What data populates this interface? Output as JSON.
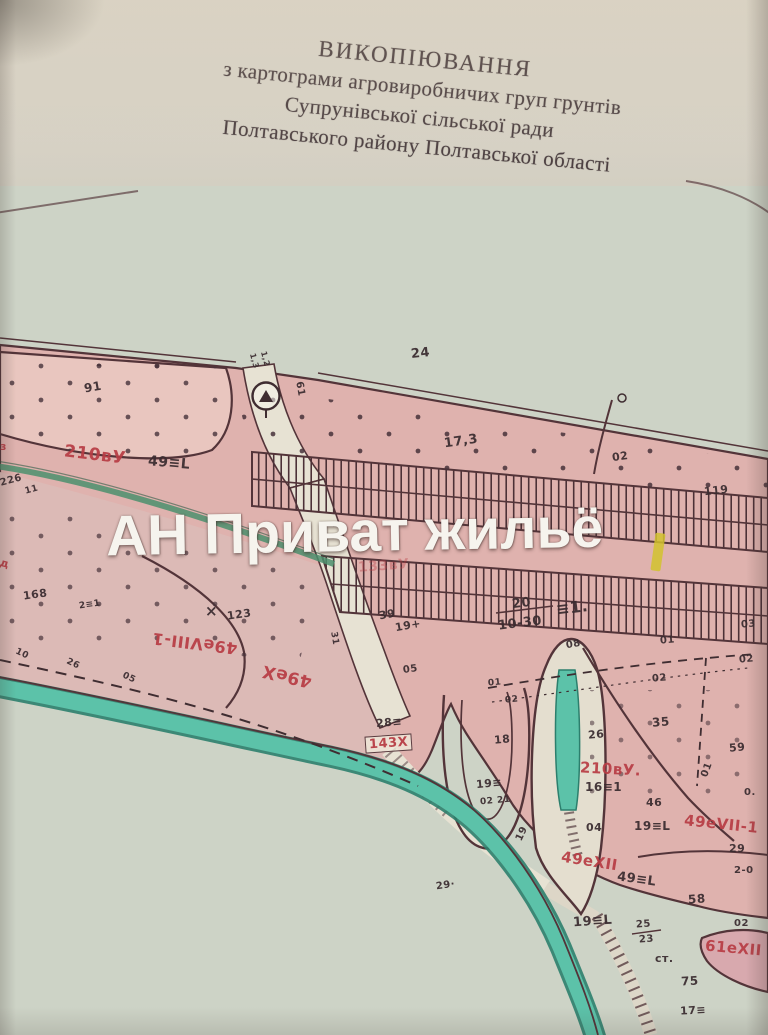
{
  "page": {
    "title_lines": [
      "ВИКОПІЮВАННЯ",
      "з картограми  агровиробничих груп грунтів",
      "Супрунівської сільської ради",
      "Полтавського району Полтавської області"
    ]
  },
  "watermark": {
    "text": "АН Приват жильё"
  },
  "map": {
    "labels": [
      {
        "t": "24",
        "x": 411,
        "y": 347,
        "s": 13,
        "r": -6
      },
      {
        "t": "91",
        "x": 84,
        "y": 381,
        "s": 12,
        "r": -10
      },
      {
        "t": "1,3",
        "x": 246,
        "y": 357,
        "s": 8,
        "r": 75
      },
      {
        "t": "1,2",
        "x": 257,
        "y": 355,
        "s": 8,
        "r": 75
      },
      {
        "t": "61",
        "x": 292,
        "y": 384,
        "s": 10,
        "r": 80
      },
      {
        "t": "17,3",
        "x": 444,
        "y": 435,
        "s": 13,
        "r": -8
      },
      {
        "t": "02",
        "x": 612,
        "y": 451,
        "s": 11,
        "r": -8
      },
      {
        "t": "119",
        "x": 704,
        "y": 485,
        "s": 11,
        "r": -6
      },
      {
        "t": "210вУ",
        "x": 64,
        "y": 447,
        "s": 17,
        "r": 7,
        "c": "r"
      },
      {
        "t": "49≡L",
        "x": 148,
        "y": 456,
        "s": 14,
        "r": 5
      },
      {
        "t": "226",
        "x": 0,
        "y": 476,
        "s": 10,
        "r": -15
      },
      {
        "t": "11",
        "x": 25,
        "y": 486,
        "s": 9,
        "r": -15
      },
      {
        "t": "з",
        "x": 0,
        "y": 441,
        "s": 11,
        "r": 0,
        "c": "r"
      },
      {
        "t": "133вУ",
        "x": 358,
        "y": 559,
        "s": 14,
        "r": -4,
        "c": "fr"
      },
      {
        "t": "20",
        "x": 512,
        "y": 597,
        "s": 13,
        "r": -7
      },
      {
        "t": "10-30",
        "x": 498,
        "y": 617,
        "s": 13,
        "r": -7
      },
      {
        "t": "≡1.",
        "x": 556,
        "y": 600,
        "s": 16,
        "r": -7
      },
      {
        "t": "39",
        "x": 379,
        "y": 609,
        "s": 11,
        "r": -10
      },
      {
        "t": "19+",
        "x": 395,
        "y": 620,
        "s": 11,
        "r": -10
      },
      {
        "t": "168",
        "x": 23,
        "y": 589,
        "s": 11,
        "r": -8
      },
      {
        "t": "2≡1",
        "x": 79,
        "y": 601,
        "s": 9,
        "r": -8
      },
      {
        "t": "×",
        "x": 205,
        "y": 604,
        "s": 15,
        "r": 0
      },
      {
        "t": "123",
        "x": 227,
        "y": 609,
        "s": 11,
        "r": -8
      },
      {
        "t": "49еVIII-1",
        "x": 152,
        "y": 635,
        "s": 16,
        "r": 187,
        "c": "r"
      },
      {
        "t": "д",
        "x": 0,
        "y": 558,
        "s": 11,
        "r": 15,
        "c": "r"
      },
      {
        "t": "49еХ",
        "x": 262,
        "y": 667,
        "s": 17,
        "r": 193,
        "c": "r"
      },
      {
        "t": "05",
        "x": 403,
        "y": 665,
        "s": 10,
        "r": -8
      },
      {
        "t": "31",
        "x": 327,
        "y": 634,
        "s": 9,
        "r": 80
      },
      {
        "t": "10",
        "x": 15,
        "y": 650,
        "s": 9,
        "r": 25
      },
      {
        "t": "26",
        "x": 66,
        "y": 660,
        "s": 9,
        "r": 25
      },
      {
        "t": "05",
        "x": 122,
        "y": 674,
        "s": 9,
        "r": 25
      },
      {
        "t": "28≡",
        "x": 376,
        "y": 717,
        "s": 11,
        "r": -5
      },
      {
        "t": "143Х",
        "x": 365,
        "y": 735,
        "s": 13,
        "r": -4,
        "c": "r",
        "box": true
      },
      {
        "t": "18",
        "x": 494,
        "y": 734,
        "s": 11,
        "r": -5
      },
      {
        "t": "26",
        "x": 588,
        "y": 729,
        "s": 11,
        "r": -5
      },
      {
        "t": "35",
        "x": 652,
        "y": 716,
        "s": 12,
        "r": -5
      },
      {
        "t": "08",
        "x": 566,
        "y": 640,
        "s": 10,
        "r": -10
      },
      {
        "t": "01",
        "x": 660,
        "y": 636,
        "s": 10,
        "r": -5
      },
      {
        "t": "02",
        "x": 652,
        "y": 674,
        "s": 10,
        "r": -5
      },
      {
        "t": "02",
        "x": 739,
        "y": 655,
        "s": 10,
        "r": -5
      },
      {
        "t": "03",
        "x": 741,
        "y": 620,
        "s": 10,
        "r": -5
      },
      {
        "t": "01",
        "x": 488,
        "y": 679,
        "s": 9,
        "r": -5
      },
      {
        "t": "02",
        "x": 505,
        "y": 696,
        "s": 9,
        "r": -5
      },
      {
        "t": "59",
        "x": 729,
        "y": 742,
        "s": 11,
        "r": -5
      },
      {
        "t": "01",
        "x": 700,
        "y": 765,
        "s": 10,
        "r": -70
      },
      {
        "t": "0.",
        "x": 744,
        "y": 788,
        "s": 10,
        "r": 0
      },
      {
        "t": "19≡",
        "x": 476,
        "y": 778,
        "s": 11,
        "r": -5
      },
      {
        "t": "02 21",
        "x": 480,
        "y": 797,
        "s": 9,
        "r": -5
      },
      {
        "t": "210вУ.",
        "x": 580,
        "y": 762,
        "s": 15,
        "r": 3,
        "c": "r"
      },
      {
        "t": "16≡1",
        "x": 585,
        "y": 781,
        "s": 12,
        "r": 0
      },
      {
        "t": "46",
        "x": 646,
        "y": 797,
        "s": 11,
        "r": 0
      },
      {
        "t": "04",
        "x": 586,
        "y": 822,
        "s": 11,
        "r": 0
      },
      {
        "t": "19≡L",
        "x": 634,
        "y": 820,
        "s": 12,
        "r": 0
      },
      {
        "t": "49еVII-1",
        "x": 684,
        "y": 817,
        "s": 15,
        "r": 6,
        "c": "r"
      },
      {
        "t": "29",
        "x": 729,
        "y": 843,
        "s": 11,
        "r": 0
      },
      {
        "t": "2-0",
        "x": 734,
        "y": 866,
        "s": 10,
        "r": 0
      },
      {
        "t": "49еХІІ",
        "x": 561,
        "y": 854,
        "s": 15,
        "r": 9,
        "c": "r"
      },
      {
        "t": "49≡L",
        "x": 617,
        "y": 873,
        "s": 13,
        "r": 8
      },
      {
        "t": "58",
        "x": 688,
        "y": 893,
        "s": 12,
        "r": -4
      },
      {
        "t": "19",
        "x": 515,
        "y": 829,
        "s": 10,
        "r": -65
      },
      {
        "t": "29·",
        "x": 436,
        "y": 881,
        "s": 10,
        "r": -8
      },
      {
        "t": "19≡L",
        "x": 573,
        "y": 915,
        "s": 13,
        "r": -4
      },
      {
        "t": "25",
        "x": 636,
        "y": 920,
        "s": 10,
        "r": -4
      },
      {
        "t": "23",
        "x": 639,
        "y": 935,
        "s": 10,
        "r": -4
      },
      {
        "t": "ст.",
        "x": 655,
        "y": 953,
        "s": 11,
        "r": 0
      },
      {
        "t": "02",
        "x": 734,
        "y": 919,
        "s": 10,
        "r": 0
      },
      {
        "t": "61еХІІ",
        "x": 705,
        "y": 941,
        "s": 15,
        "r": 5,
        "c": "r"
      },
      {
        "t": "75",
        "x": 681,
        "y": 975,
        "s": 12,
        "r": -3
      },
      {
        "t": "17≡",
        "x": 680,
        "y": 1005,
        "s": 11,
        "r": -3
      }
    ]
  },
  "colors": {
    "paper": "#d6d1c5",
    "sheet": "#cdd3c6",
    "pink": "#dfb2ae",
    "pink_light": "#e9c6bf",
    "pink_mid": "#dcbab6",
    "pink_deep": "#d2a3a8",
    "pink_rose": "#d8a9ae",
    "line": "#533439",
    "ink": "#3a2c30",
    "red_label": "#b83d45",
    "teal": "#5cc2a9",
    "teal_dark": "#2c7f6d",
    "highlight": "#d2c22e",
    "watermark": "#f6f4ee"
  }
}
